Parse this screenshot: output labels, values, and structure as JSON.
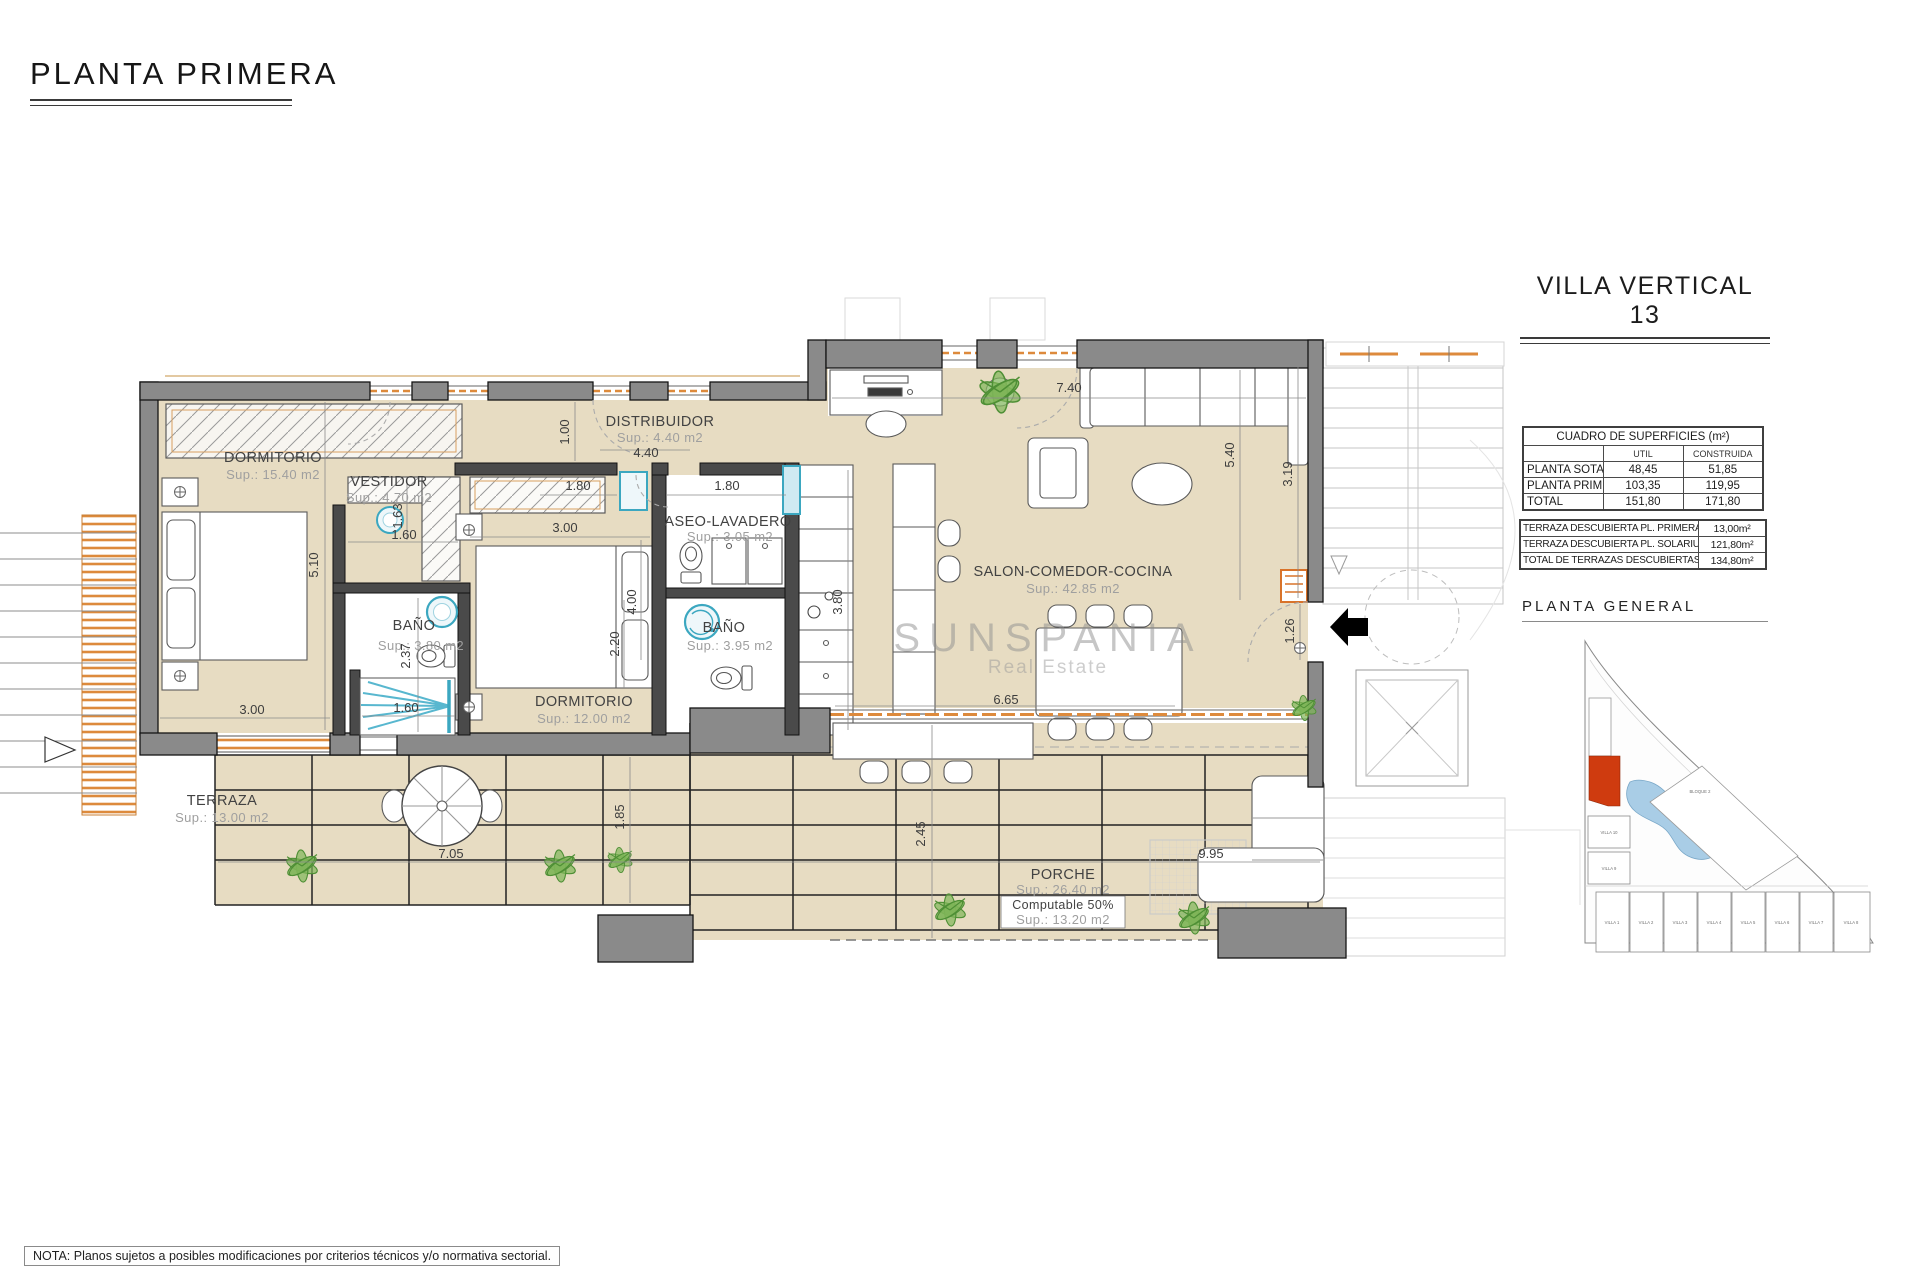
{
  "page": {
    "title": "PLANTA PRIMERA",
    "note": "NOTA: Planos sujetos a posibles modificaciones por criterios técnicos y/o normativa sectorial.",
    "watermark": {
      "brand": "SUNSPANIA",
      "tagline": "Real Estate"
    }
  },
  "panel": {
    "title": "VILLA VERTICAL 13",
    "surface_table": {
      "title": "CUADRO DE SUPERFICIES (m²)",
      "col_util": "UTIL",
      "col_construida": "CONSTRUIDA",
      "rows": [
        {
          "label": "PLANTA SOTANO",
          "util": "48,45",
          "construida": "51,85"
        },
        {
          "label": "PLANTA PRIMERA",
          "util": "103,35",
          "construida": "119,95"
        },
        {
          "label": "TOTAL",
          "util": "151,80",
          "construida": "171,80"
        }
      ]
    },
    "terrace_table": {
      "rows": [
        {
          "label": "TERRAZA DESCUBIERTA PL. PRIMERA",
          "value": "13,00m²"
        },
        {
          "label": "TERRAZA DESCUBIERTA PL. SOLARIUM",
          "value": "121,80m²"
        },
        {
          "label": "TOTAL DE TERRAZAS DESCUBIERTAS",
          "value": "134,80m²"
        }
      ]
    },
    "site": {
      "title": "PLANTA GENERAL",
      "bloque": "BLOQUE 2",
      "villa10": "VILLA 10",
      "villa9": "VILLA 9",
      "villas": [
        "VILLA 1",
        "VILLA 2",
        "VILLA 3",
        "VILLA 4",
        "VILLA 5",
        "VILLA 6",
        "VILLA 7",
        "VILLA 8"
      ],
      "highlight_color": "#cf3b0f",
      "pool_color": "#a9cde6"
    }
  },
  "plan": {
    "rooms": {
      "dorm1": {
        "name": "DORMITORIO",
        "area": "Sup.: 15.40  m2"
      },
      "vestidor": {
        "name": "VESTIDOR",
        "area": "Sup.: 4.70   m2"
      },
      "distribuidor": {
        "name": "DISTRIBUIDOR",
        "area": "Sup.: 4.40   m2"
      },
      "aseo": {
        "name": "ASEO-LAVADERO",
        "area": "Sup.: 3.05   m2"
      },
      "bano1": {
        "name": "BAÑO",
        "area": "Sup.: 3.80   m2"
      },
      "bano2": {
        "name": "BAÑO",
        "area": "Sup.: 3.95   m2"
      },
      "dorm2": {
        "name": "DORMITORIO",
        "area": "Sup.: 12.00  m2"
      },
      "salon": {
        "name": "SALON-COMEDOR-COCINA",
        "area": "Sup.: 42.85  m2"
      },
      "terraza": {
        "name": "TERRAZA",
        "area": "Sup.: 13.00  m2"
      },
      "porche": {
        "name": "PORCHE",
        "area": "Sup.: 26.40 m2",
        "note1": "Computable 50%",
        "note2": "Sup.: 13.20 m2"
      }
    },
    "dims": {
      "d510": "5.10",
      "d300a": "3.00",
      "d163": "1.63",
      "d160a": "1.60",
      "d100": "1.00",
      "d440": "4.40",
      "d300b": "3.00",
      "d180a": "1.80",
      "d180b": "1.80",
      "d400": "4.00",
      "d237": "2.37",
      "d160b": "1.60",
      "d220": "2.20",
      "d380": "3.80",
      "d740": "7.40",
      "d319": "3.19",
      "d540": "5.40",
      "d126": "1.26",
      "d665": "6.65",
      "d705": "7.05",
      "d185": "1.85",
      "d245": "2.45",
      "d995": "9.95"
    }
  }
}
